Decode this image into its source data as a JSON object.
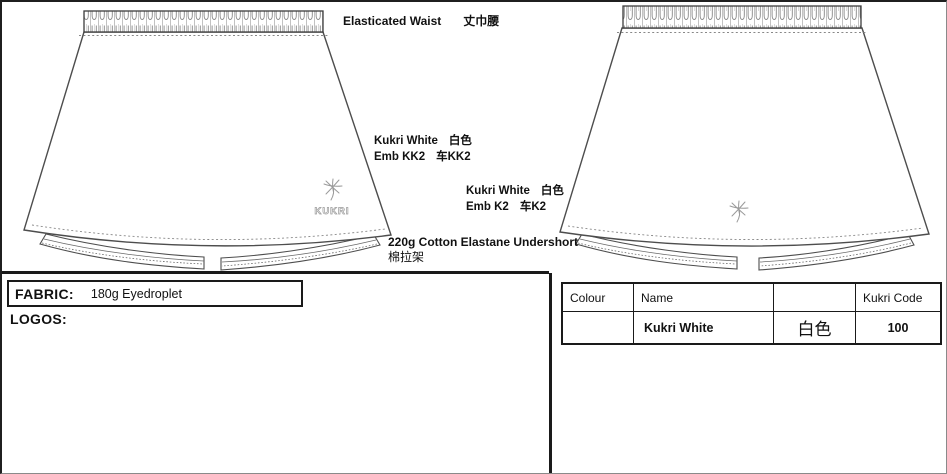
{
  "annotations": {
    "elasticated_waist": {
      "en": "Elasticated Waist",
      "zh": "丈巾腰"
    },
    "emb_front": {
      "name_en": "Kukri White",
      "name_zh": "白色",
      "emb_en": "Emb KK2",
      "emb_zh": "车KK2"
    },
    "emb_back": {
      "name_en": "Kukri White",
      "name_zh": "白色",
      "emb_en": "Emb K2",
      "emb_zh": "车K2"
    },
    "undershort": {
      "en": "220g Cotton Elastane Undershort",
      "zh": "棉拉架"
    }
  },
  "fabric": {
    "label": "FABRIC:",
    "value": "180g Eyedroplet"
  },
  "logos_label": "LOGOS:",
  "colour_table": {
    "headers": [
      "Colour",
      "Name",
      "",
      "Kukri Code"
    ],
    "row": {
      "colour_swatch": "",
      "name": "Kukri White",
      "name_zh": "白色",
      "kukri_code": "100"
    }
  },
  "drawing": {
    "logo_text": "KUKRI",
    "views": [
      "front-skirt",
      "back-skirt"
    ]
  },
  "colors": {
    "line_art": "#4d4d4d",
    "stitch": "#888888",
    "border": "#1a1a1a",
    "logo_gray": "#9a9a9a"
  }
}
